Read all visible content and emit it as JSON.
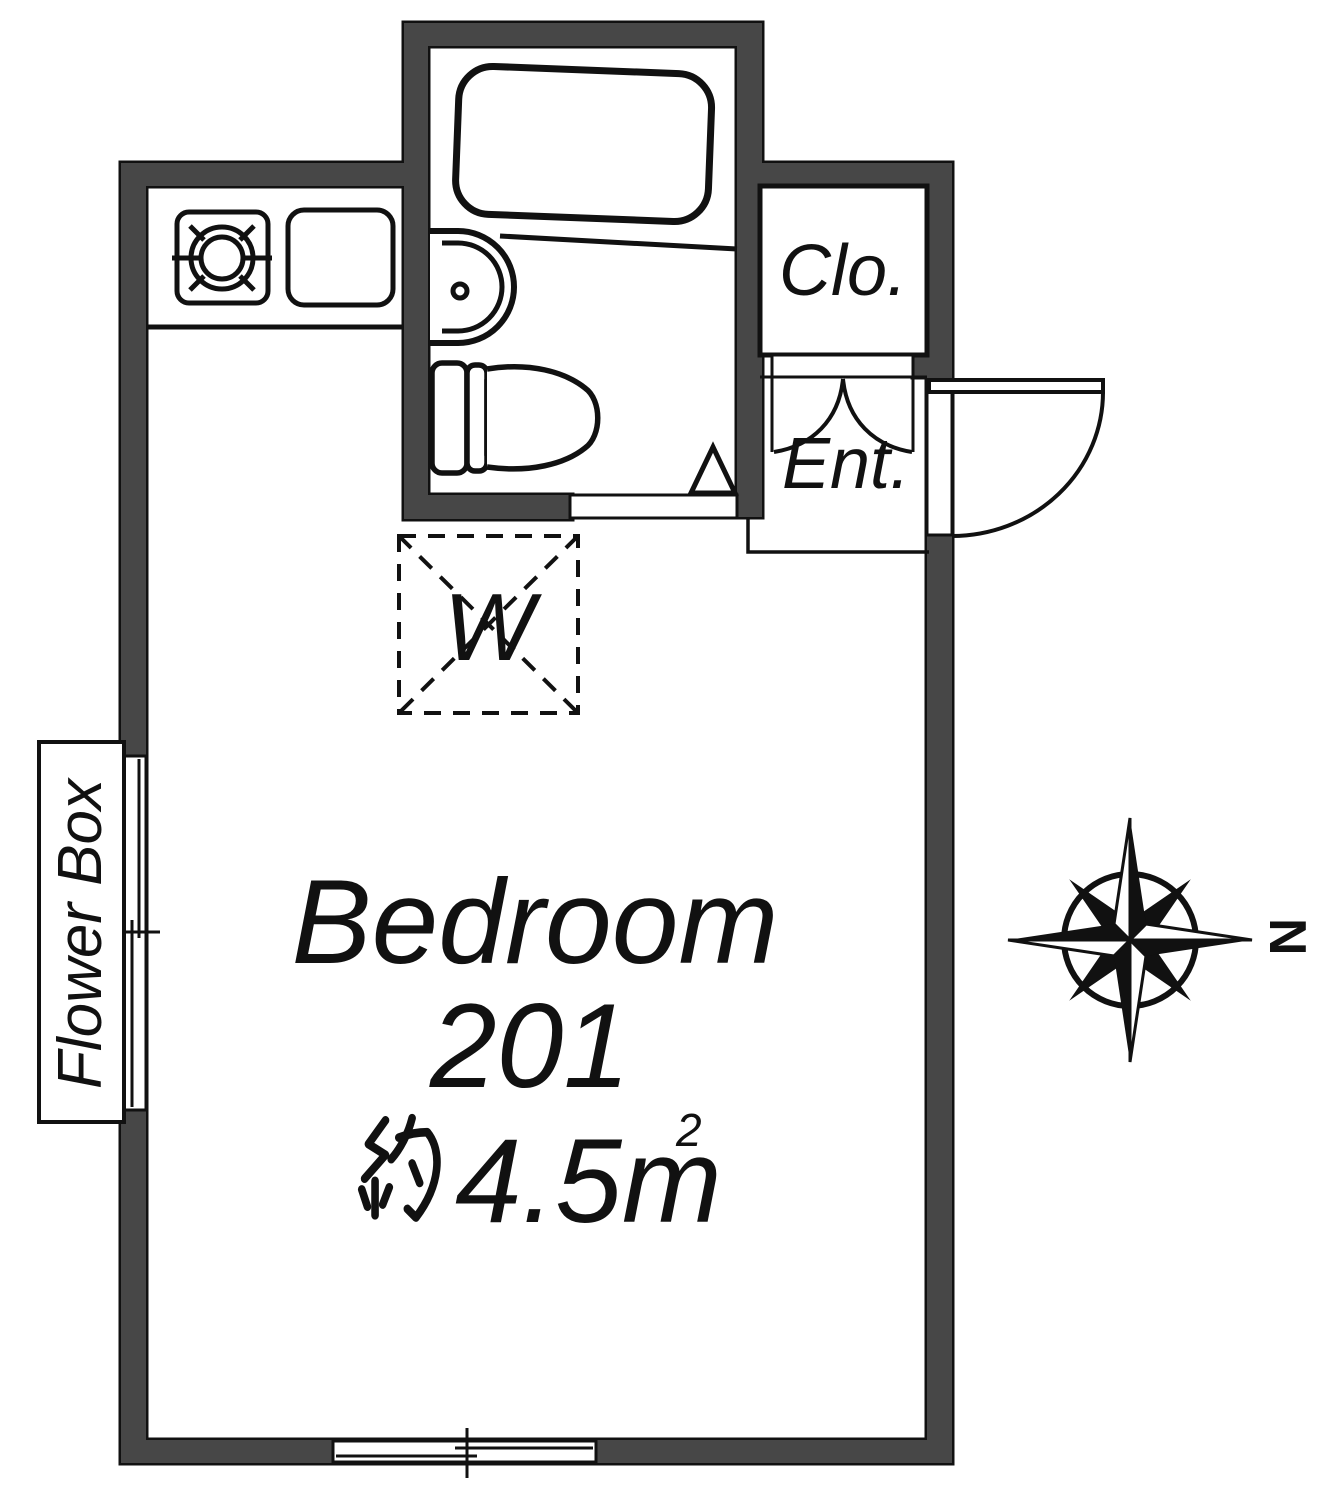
{
  "plan": {
    "room_label_line1": "Bedroom",
    "room_label_line2": "201",
    "area_label": "約4.5m²",
    "area_prefix_kanji": "約",
    "area_value": "4.5m",
    "area_sup": "2",
    "closet_label": "Clo.",
    "entrance_label": "Ent.",
    "washer_label": "W",
    "flower_box_label": "Flower Box",
    "compass_north_label": "N"
  },
  "colors": {
    "wall_fill": "#474747",
    "line": "#111111",
    "background": "#ffffff"
  },
  "icons": {
    "compass": "compass-rose-icon",
    "stove": "stove-burner-icon",
    "kitchen_sink": "kitchen-sink-icon",
    "bathtub": "bathtub-icon",
    "washbasin": "washbasin-icon",
    "toilet": "toilet-icon",
    "washer_square": "washing-machine-icon",
    "entrance_door": "door-swing-icon",
    "curtain": "entrance-curtain-icon",
    "kanji": "kanji-yaku-icon",
    "window": "sliding-window-icon",
    "door_marker": "door-triangle-icon"
  }
}
